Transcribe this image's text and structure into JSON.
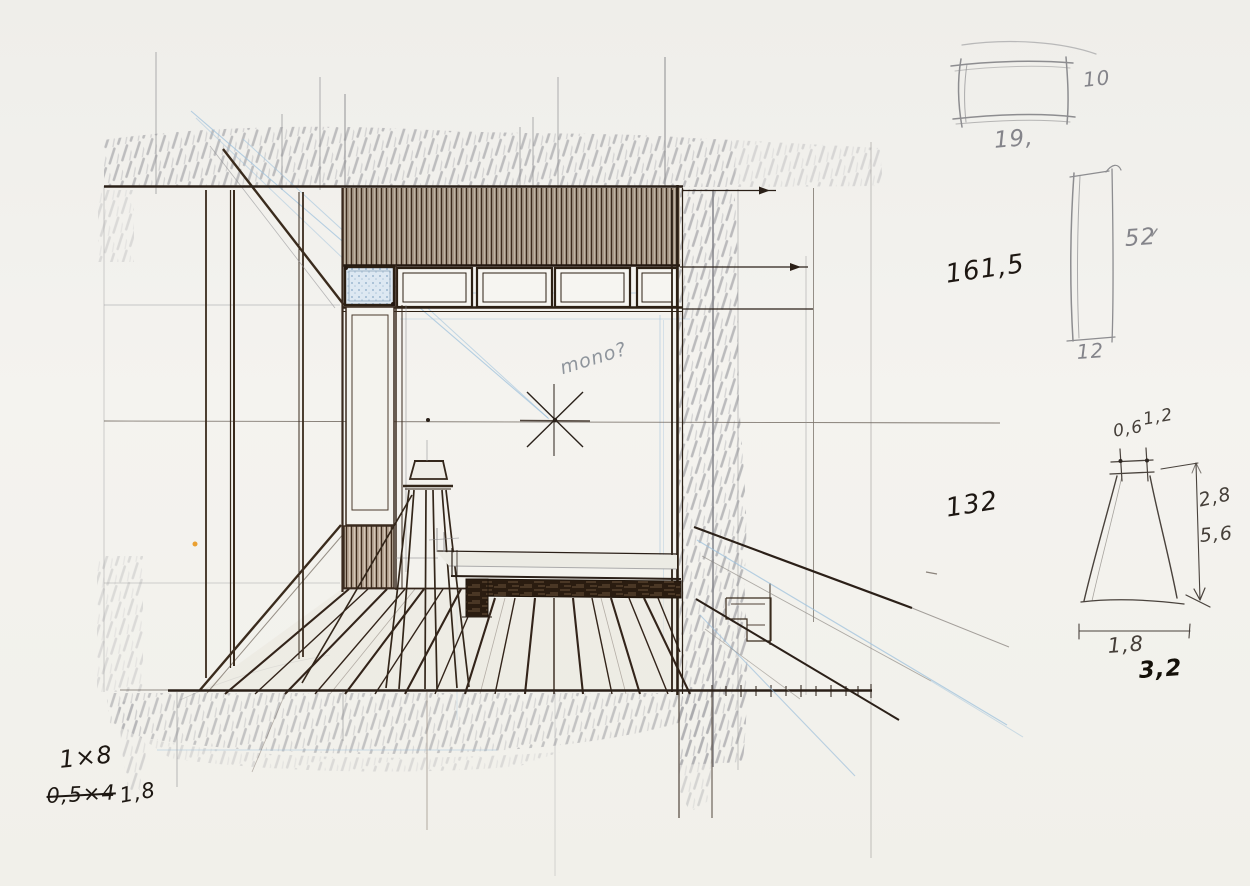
{
  "document": {
    "kind": "hand-drawn interior perspective sketch",
    "paper_color": "#f2f1ed"
  },
  "colors": {
    "ink": "#2b2018",
    "pencil_gray": "#8e8e91",
    "blue_pencil": "#9fc1dc",
    "annotation_ink": "#1d1712",
    "annotation_pencil": "#84848a",
    "wood_dark": "#2a1c10",
    "orange_dot": "#e8920f"
  },
  "center_note": {
    "text": "mono?"
  },
  "detail_plan_rect": {
    "dim_right": "10",
    "dim_bottom": "19,"
  },
  "detail_post": {
    "dim_right": "52",
    "dim_bottom": "12"
  },
  "dim_labels": {
    "wall_height": "161,5",
    "opening_height": "132"
  },
  "detail_stool": {
    "top_width": "0,6",
    "top_offset": "1,2",
    "height_part": "2,8",
    "height_total": "5,6",
    "base_width": "1,8",
    "base_total": "3,2"
  },
  "calc_notes": {
    "line1": "1×8",
    "line2_struck": "0,5×4",
    "line2_result": "1,8"
  }
}
